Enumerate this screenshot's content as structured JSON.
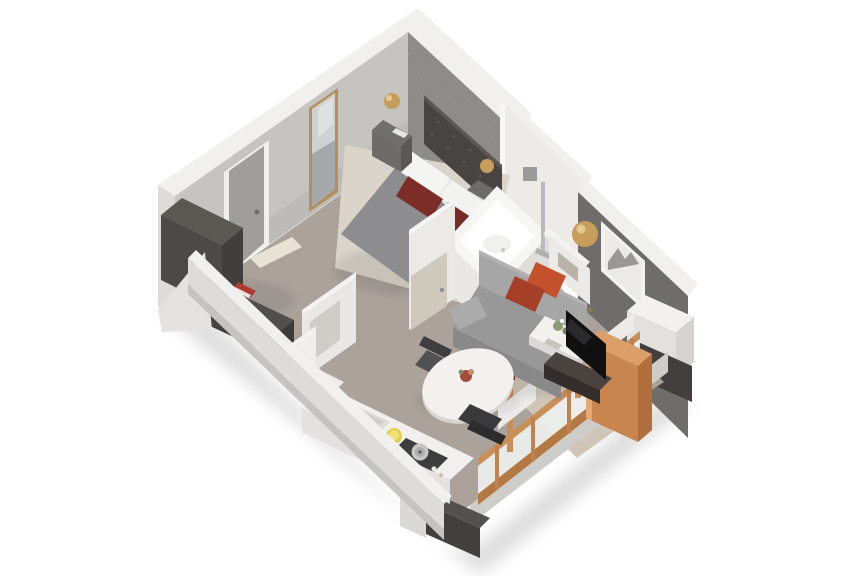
{
  "scene": {
    "description": "3D isometric cutaway render of a studio apartment floor plan",
    "view": "top-down isometric cutaway",
    "background": "#ffffff",
    "rooms": [
      "bedroom",
      "bathroom",
      "living-area",
      "dining-area",
      "kitchen",
      "entry"
    ],
    "furniture": [
      "double-bed",
      "upholstered-headboard",
      "white-pillows",
      "maroon-pillows",
      "nightstands",
      "gold-table-lamps",
      "wall-mirror",
      "entry-door",
      "dark-wardrobe",
      "storage-console",
      "red-books",
      "bathtub",
      "shower-fixture",
      "bathroom-door",
      "gray-sofa",
      "accent-pillows",
      "gold-floor-lamp",
      "framed-wall-art",
      "coffee-table",
      "flat-screen-tv",
      "tv-stand",
      "copper-panel-wardrobe",
      "round-dining-table",
      "dining-chairs",
      "kitchen-counter",
      "sink",
      "gas-cooktop",
      "copper-framed-window-wall",
      "radiators"
    ]
  },
  "colors": {
    "background": "#ffffff",
    "wallTop": "#f1f0ee",
    "wallOuter": "#dedcd8",
    "wallInner": "#c6c4c0",
    "wallInnerShade": "#b7b5b1",
    "accentWall": "#8f8d8a",
    "marbleWall": "#edebe8",
    "darkWall": "#6f6d6b",
    "floorWood": "#aaa29b",
    "plankLine": "#958d85",
    "carpet": "#dad4ca",
    "rug": "#cfc6b7",
    "doorFrame": "#f0efed",
    "doorPanel": "#a09e9a",
    "mirrorFrame": "#b3905a",
    "mirrorGlass": "#cfd1d3",
    "wardrobe": "#403f3c",
    "wardrobeTop": "#5a5853",
    "consoleDark": "#504f4b",
    "bookRed": "#ae3a2f",
    "headboard": "#474441",
    "bedDuvet": "#8d8d8f",
    "bedSheet": "#ebebe9",
    "pillowWhite": "#f5f5f3",
    "pillowMaroon": "#7c2d27",
    "nightstand": "#6e6c68",
    "gold": "#c69d5b",
    "tubWhite": "#f6f6f4",
    "tubInner": "#ffffff",
    "platformFace": "#e9e8e5",
    "partitionWhite": "#eceae7",
    "woodDoor": "#cfc9bd",
    "sofaBack": "#a6a6a6",
    "sofaSeat": "#989898",
    "sofaFront": "#898989",
    "pillowOrange": "#c4512c",
    "pillowRust": "#a63f28",
    "coffeeTable": "#f2f1ee",
    "tvBlack": "#101010",
    "tvStand": "#4a423f",
    "copper": "#c9854f",
    "copperLight": "#dc9f69",
    "copperDark": "#b06f3d",
    "glass": "#eef0ef",
    "brick": "#433f3e",
    "brickLine": "#5f5d5b",
    "tableTop": "#f3f1ee",
    "tableRim": "#d9d6d1",
    "chairDark": "#3e3e40",
    "chairMid": "#515154",
    "counterTop": "#f1f0ee",
    "counterFace": "#e3e2df",
    "sinkGray": "#dddcd9",
    "cooktop": "#3d3d3d",
    "potSilver": "#c7c7c7",
    "bowlYellow": "#e5cf49",
    "radiator": "#ecebe9",
    "artFrame": "#f4f3f1",
    "artPaper": "#eceae7"
  }
}
